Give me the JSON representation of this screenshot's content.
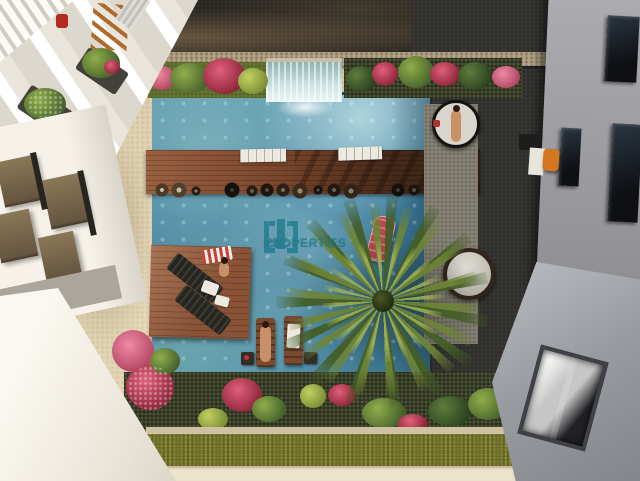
{
  "scene": {
    "type": "architectural-aerial-render",
    "description": "Top-down 3D rendering of a residential courtyard swimming pool between two apartment buildings, with swim-up bar, wooden decks, sun loungers, round daybeds, waterfall feature, palm tree, flowering planters and lawn strip",
    "watermark": {
      "brand_line1": "CIC",
      "brand_line2": "PROPERTIES",
      "color": "#1f7d8e"
    },
    "objects": [
      "left-apartment-building",
      "balconies-with-plants",
      "white-roof",
      "right-apartment-building",
      "roof-skylight",
      "terrace-orange-chair",
      "swimming-pool",
      "waterfall-feature",
      "swim-up-bar",
      "bar-stools",
      "wooden-deck-platform",
      "dark-sun-loungers",
      "in-pool-loungers",
      "swimmer",
      "sunbathers",
      "round-daybeds",
      "red-pool-float",
      "palm-tree",
      "flower-planters",
      "lawn-strip",
      "stone-walkway",
      "cream-path"
    ],
    "palette": {
      "paving_sand": "#d8c8a4",
      "asphalt_dark": "#27241f",
      "stone_curb": "#b3a486",
      "stone_walk": "#8a8679",
      "deck_stone": "#2e2d2a",
      "pool_deep": "#3c7b99",
      "deck_wood": "#8a5336",
      "grass_olive": "#7b7b30",
      "path_cream": "#ece3cb",
      "flower_red": "#c03f54",
      "flower_pink": "#d76d88",
      "float_red": "#b84a4e",
      "chair_orange": "#d4761f",
      "daybed_cushion": "#d9d5cd",
      "skin_tan": "#c79067",
      "teal_brand": "#1f7d8e"
    }
  }
}
